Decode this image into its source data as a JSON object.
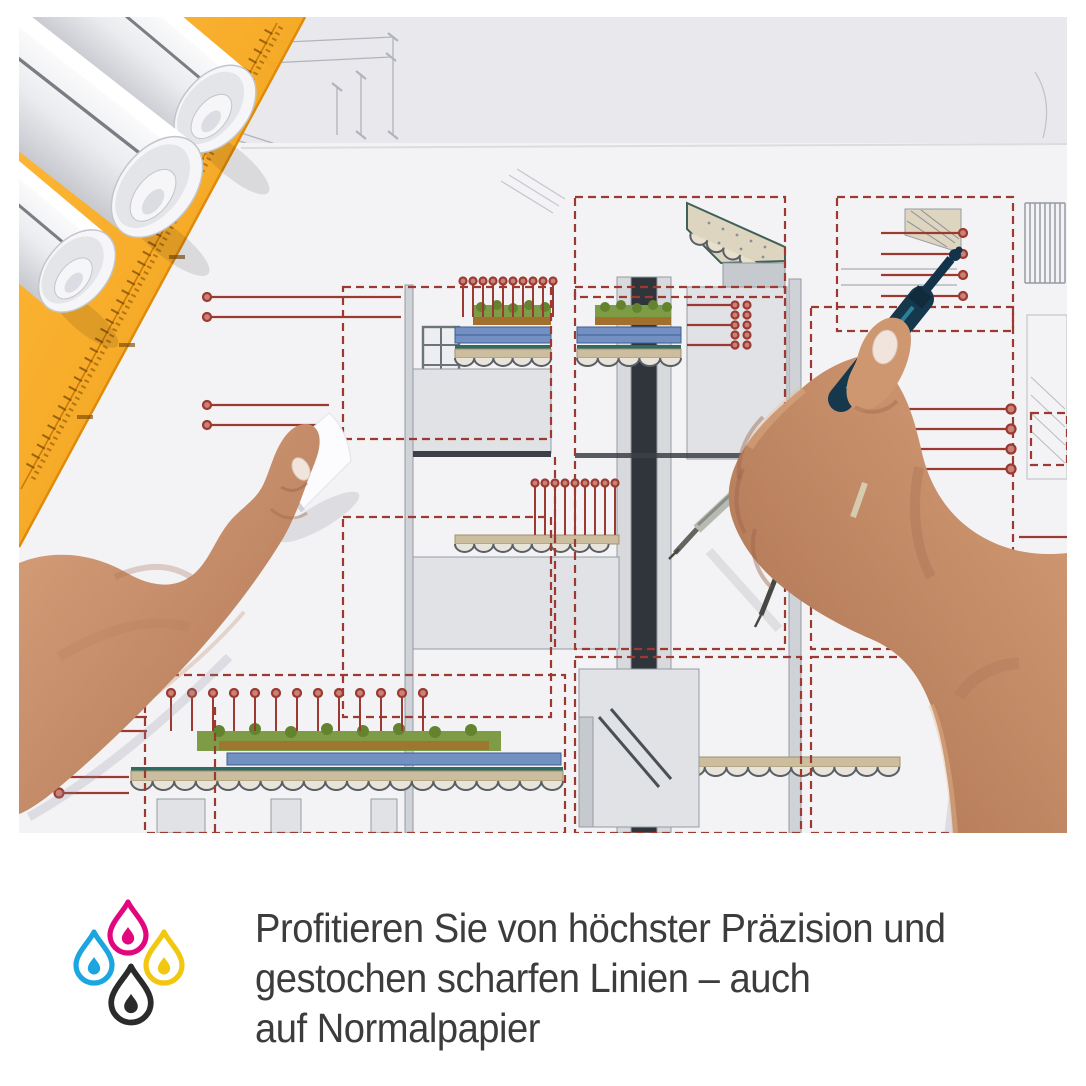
{
  "caption": {
    "lines": [
      "Profitieren Sie von höchster Präzision und",
      "gestochen scharfen Linien – auch",
      "auf Normalpapier"
    ],
    "text_color": "#3c3c3c"
  },
  "ink_drops_icon": {
    "cyan": "#1ca6e0",
    "magenta": "#e1077e",
    "yellow": "#f2c70f",
    "black": "#2b2b2b"
  },
  "photo": {
    "description": "Two hands working over an architectural blueprint: left hand holding the sheet, right hand guiding a drafting compass; rolled plans and an orange set square in the top-left corner",
    "annotation_red": "#9c3a31",
    "setsquare_orange": "#f6a11c",
    "compass_teal": "#16384c",
    "paper_gray": "#f3f3f6"
  }
}
